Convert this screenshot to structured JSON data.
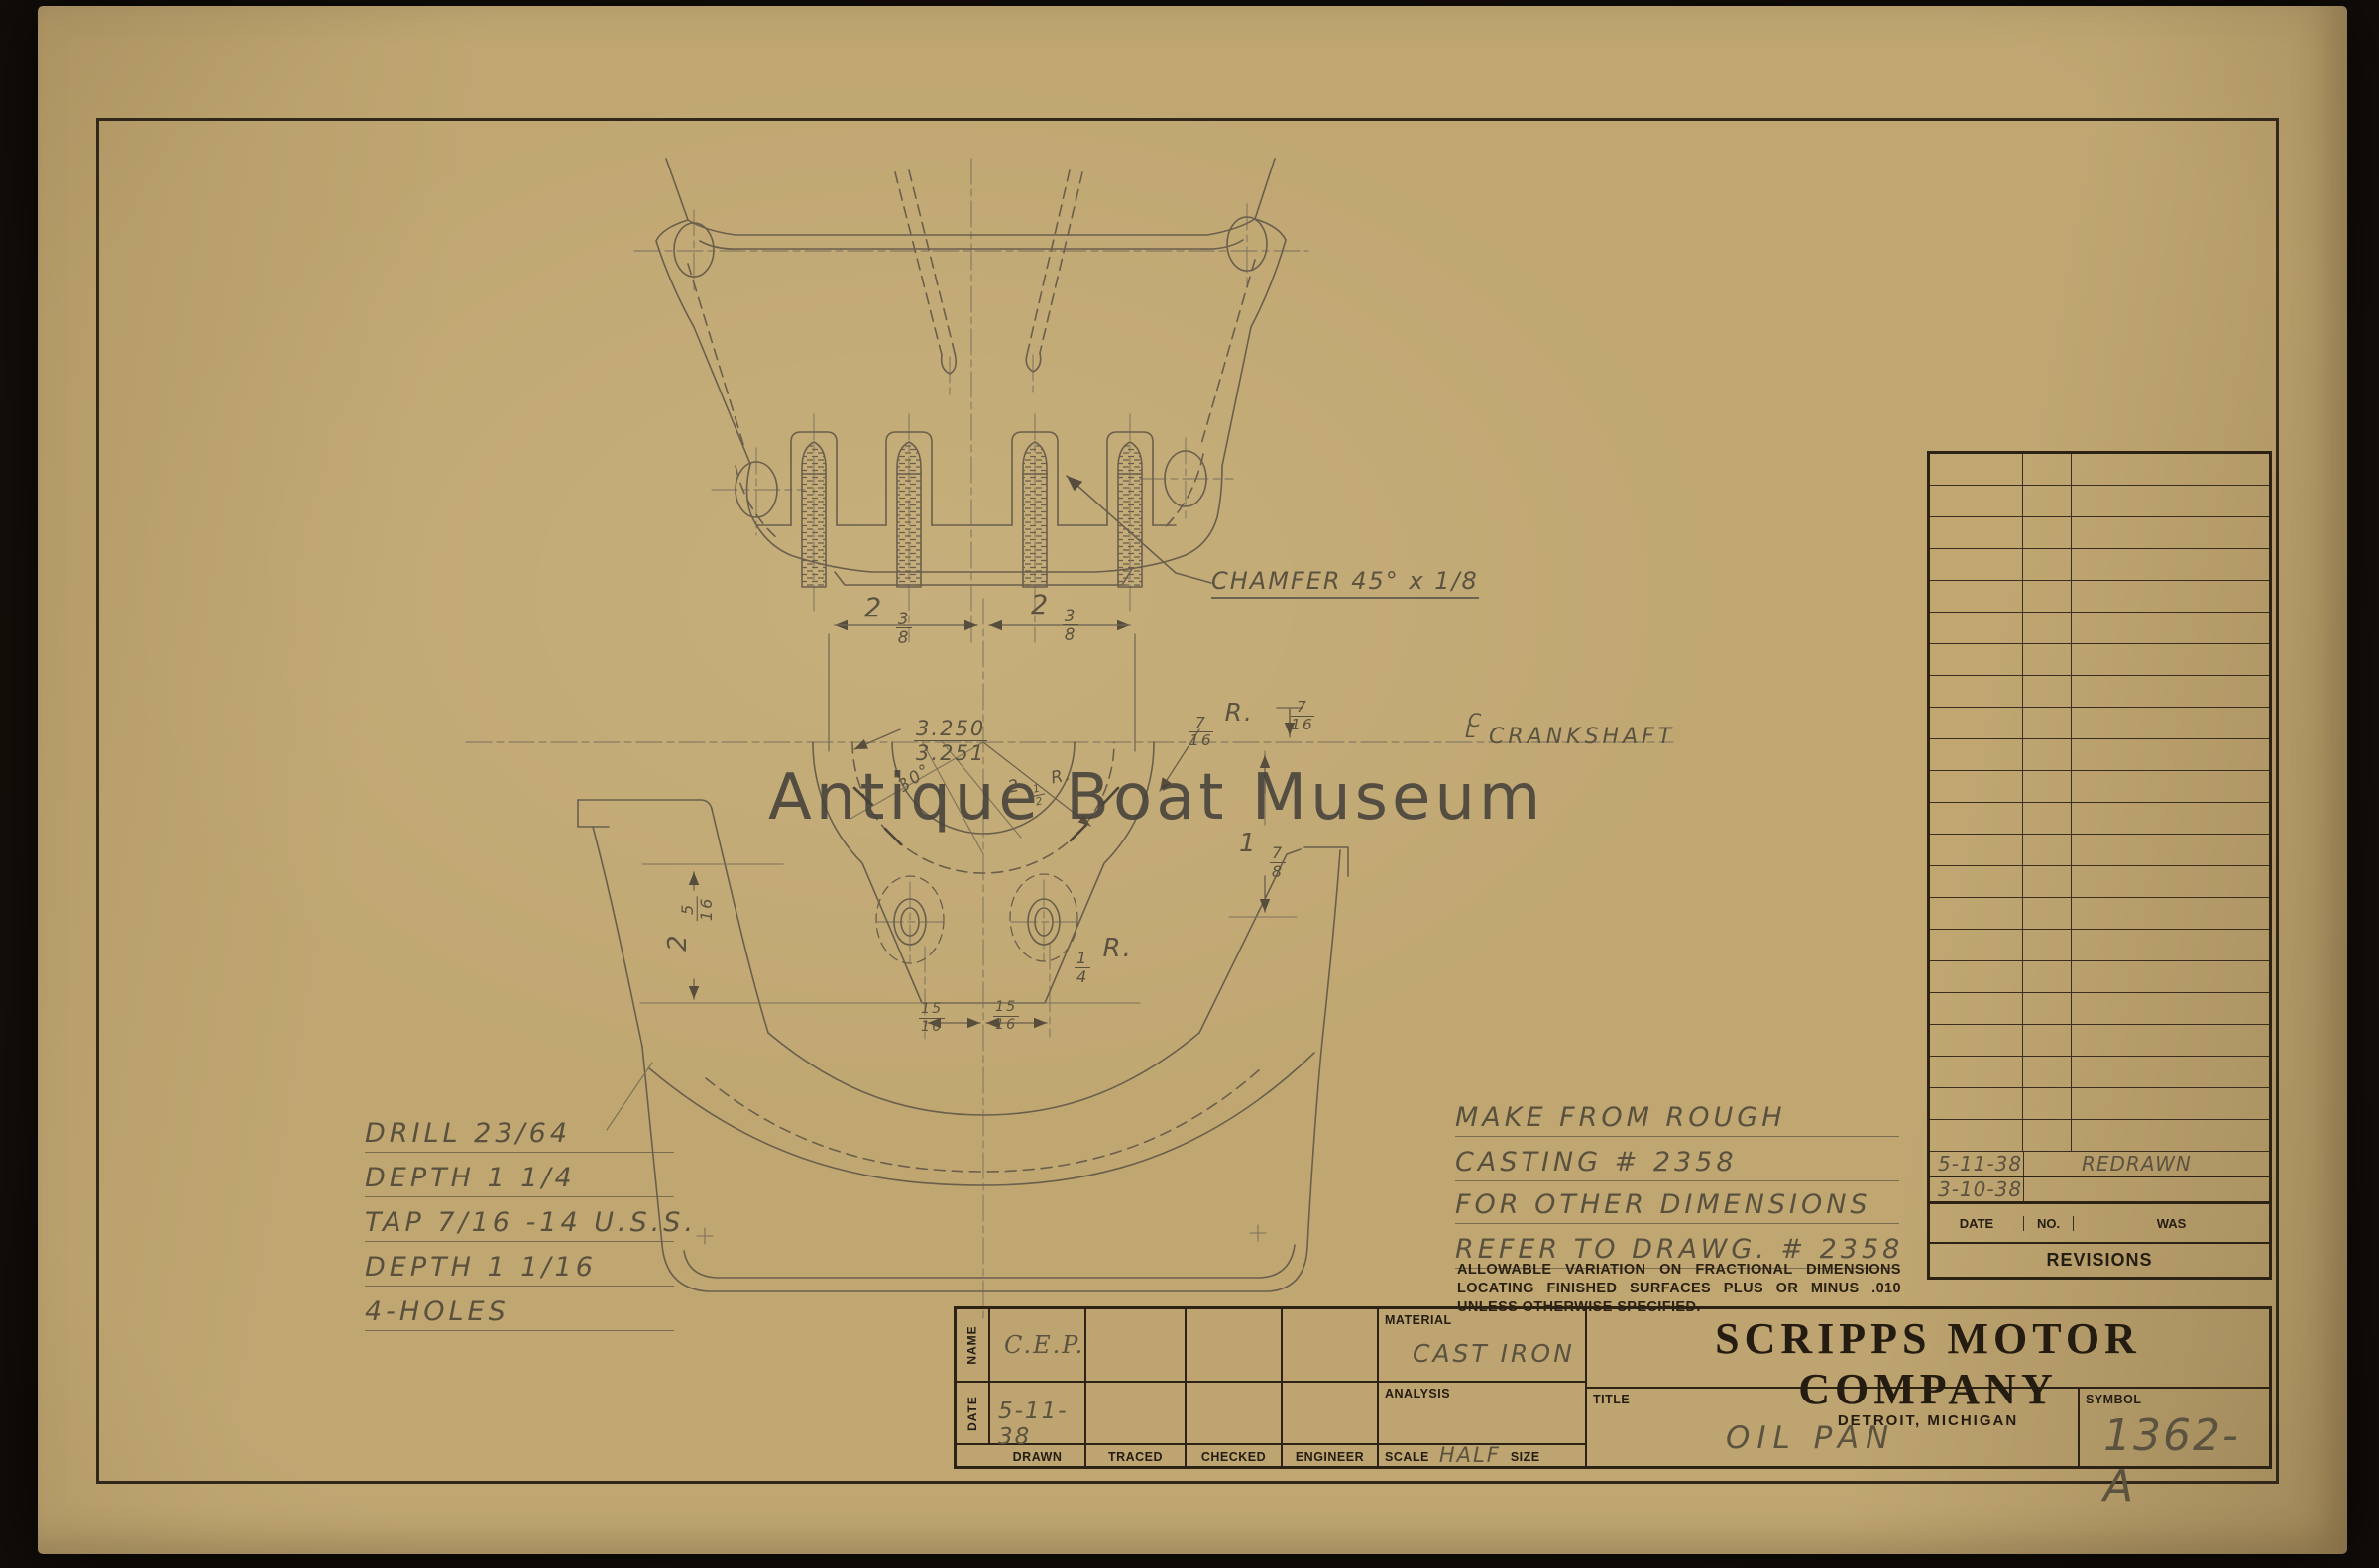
{
  "watermark": "Antique Boat Museum",
  "company": {
    "name": "SCRIPPS MOTOR COMPANY",
    "location": "DETROIT, MICHIGAN"
  },
  "title_block": {
    "name_label": "NAME",
    "date_label": "DATE",
    "name_value": "C.E.P.",
    "date_value": "5-11-38",
    "drawn_label": "DRAWN",
    "traced_label": "TRACED",
    "checked_label": "CHECKED",
    "engineer_label": "ENGINEER",
    "material_label": "MATERIAL",
    "material_value": "CAST IRON",
    "analysis_label": "ANALYSIS",
    "scale_label": "SCALE",
    "scale_value": "HALF",
    "scale_suffix": "SIZE",
    "title_label": "TITLE",
    "title_value": "OIL PAN",
    "symbol_label": "SYMBOL",
    "symbol_value": "1362-A"
  },
  "revisions": {
    "title": "REVISIONS",
    "date_header": "DATE",
    "no_header": "NO.",
    "was_header": "WAS",
    "empty_row_count": 22,
    "entries": [
      {
        "date": "5-11-38",
        "no": "",
        "was": "REDRAWN"
      },
      {
        "date": "3-10-38",
        "no": "",
        "was": ""
      }
    ]
  },
  "notes": {
    "drill": [
      "DRILL 23/64",
      "DEPTH 1 1/4",
      "TAP 7/16 -14 U.S.S.",
      "DEPTH 1 1/16",
      "4-HOLES"
    ],
    "casting": [
      "MAKE FROM ROUGH",
      "CASTING # 2358"
    ],
    "refer": [
      "FOR OTHER DIMENSIONS",
      "REFER TO DRAWG. # 2358"
    ],
    "tolerance": "ALLOWABLE VARIATION ON FRACTIONAL DIMENSIONS LOCATING FINISHED SURFACES PLUS OR MINUS .010 UNLESS OTHERWISE SPECIFIED."
  },
  "dimensions": {
    "chamfer": "CHAMFER 45° x 1/8",
    "spacing_left": "2 3/8",
    "spacing_right": "2 3/8",
    "bore": "3.250/3.251",
    "radius_7_16": "7/16 R.",
    "offset_7_16": "7/16",
    "crankshaft": "CRANKSHAFT",
    "angle_30": "30°",
    "radius_2_5": "2 1/2 R.",
    "depth_left": "2 5/16",
    "depth_right": "1 7/8",
    "radius_1_4": "1/4 R.",
    "stud_left": "15/16",
    "stud_right": "15/16"
  }
}
